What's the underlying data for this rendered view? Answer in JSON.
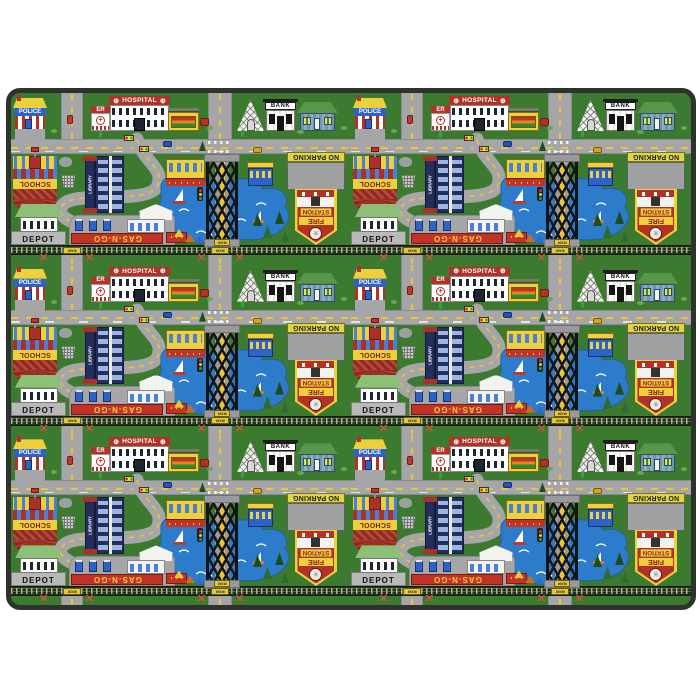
{
  "scene": {
    "background_color": "#ffffff",
    "subject": "children's city roads play rug, repeating town pattern, 2 columns x 3 rows"
  },
  "rug": {
    "border_color": "#2e322c",
    "grass_color": "#3c7a30",
    "pattern_repeat": {
      "columns": 2,
      "rows": 3
    },
    "roads": {
      "asphalt": "#a6a6a8",
      "center_dash": "#e8c636",
      "edge": "#8b8b8d",
      "crosswalk": "#ffffff"
    },
    "railroad": {
      "band": "#1e3120",
      "ties": "#b7b286",
      "plate_bg": "#e2c83e",
      "crossbuck_color": "#cf5340"
    },
    "pond": {
      "water": "#2d7ccc",
      "waves": "#ffffff"
    },
    "labels": {
      "police": "POLICE",
      "er": "ER",
      "hospital": "HOSPITAL",
      "medical_symbol": "⊕",
      "bank": "BANK",
      "school": "SCHOOL",
      "library": "LIBRARY",
      "no_parking": "NO PARKING",
      "fire_line1": "FIRE",
      "fire_line2": "STATION",
      "depot": "DEPOT",
      "gas": "GAS-N-GO",
      "rxr": "RXR",
      "crossbuck_glyph": "✕",
      "wheel_glyph": "✳",
      "er_cross": "+"
    },
    "palette": {
      "yellow": "#eecf3c",
      "red": "#b23227",
      "dark_red": "#8c2218",
      "police_blue": "#2d63c8",
      "library_navy": "#242e5c",
      "house_wall": "#6f95ad",
      "house_roof": "#57974a",
      "depot_roof": "#8cc077",
      "sign_gray": "#9ea0a2"
    }
  }
}
